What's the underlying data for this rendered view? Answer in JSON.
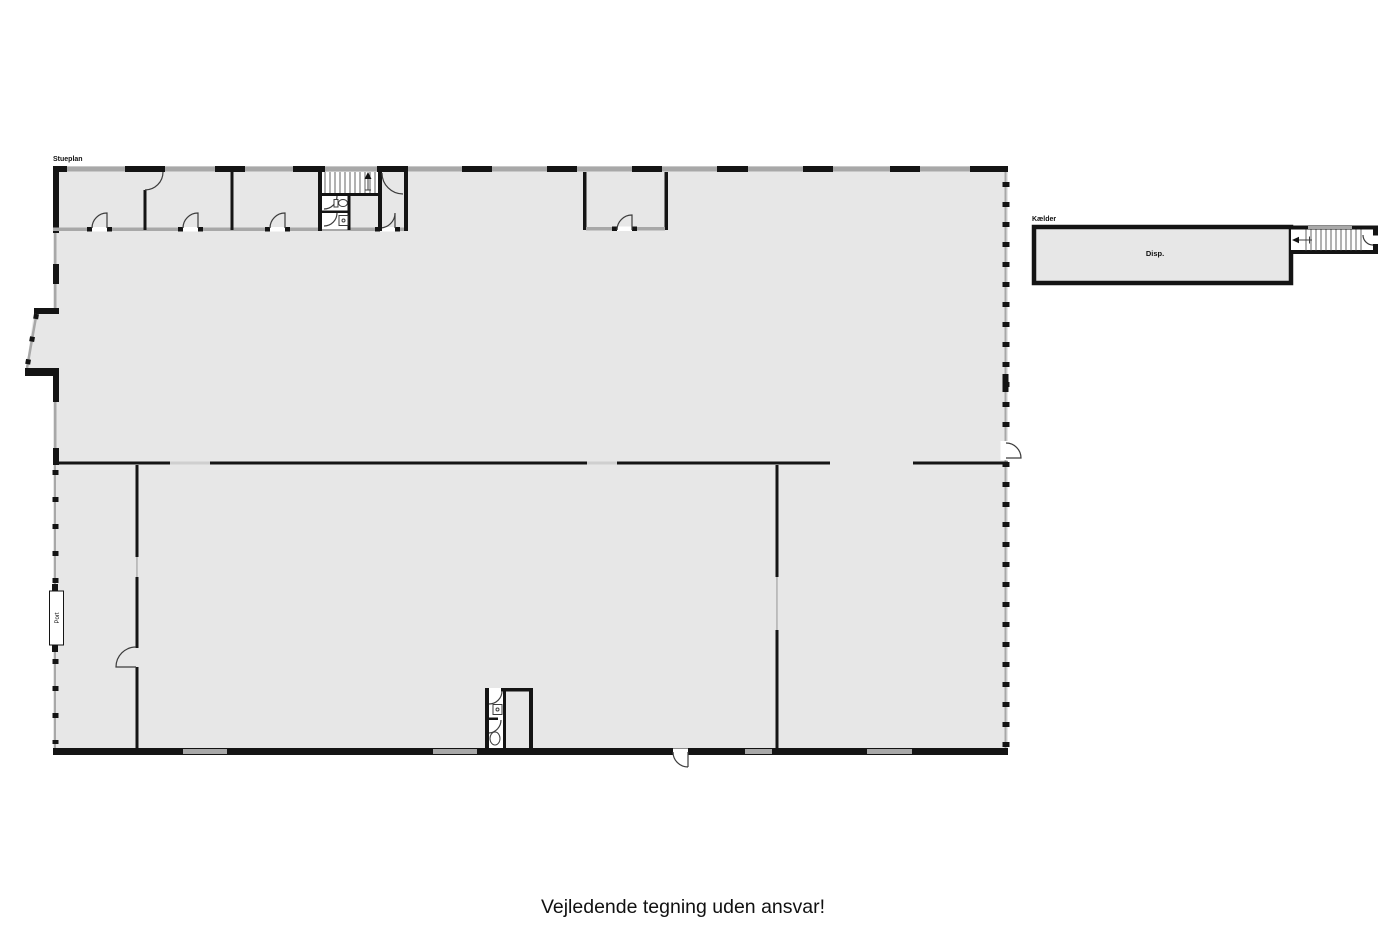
{
  "page": {
    "footer_note": "Vejledende tegning uden ansvar!"
  },
  "colors": {
    "background": "#ffffff",
    "wall": "#141414",
    "window": "#a8a8a8",
    "gap": "#cfcfcf",
    "floor": "#e7e7e7",
    "hatch": "#666666",
    "arc": "#3c3c3c",
    "text": "#111111"
  },
  "stueplan": {
    "title": "Stueplan",
    "port_label": "Port"
  },
  "kaelder": {
    "title": "Kælder",
    "room_label": "Disp."
  }
}
